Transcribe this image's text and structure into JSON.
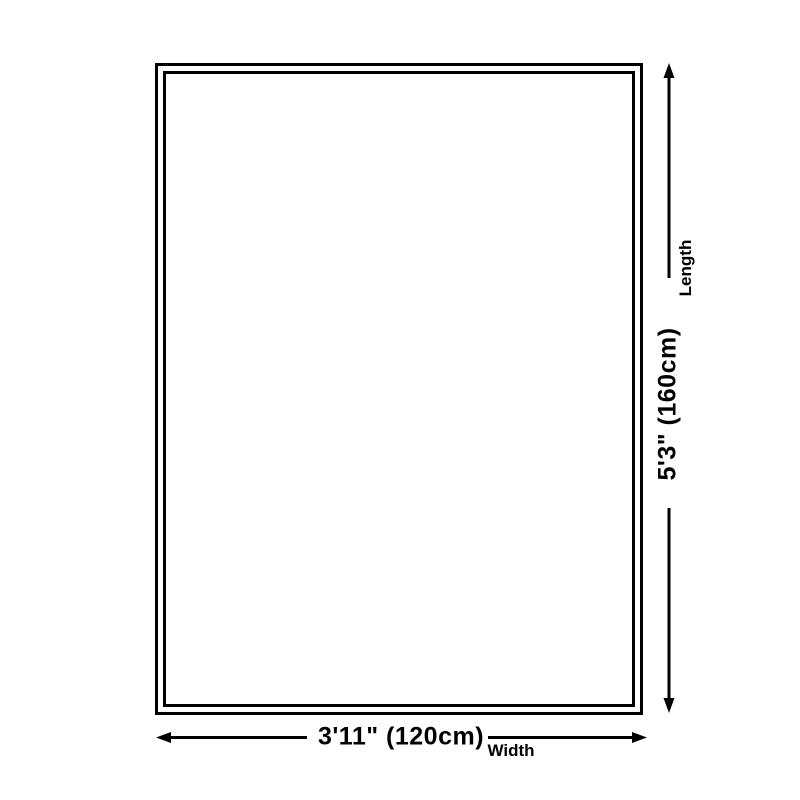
{
  "dimensions": {
    "length": {
      "value": "5'3\" (160cm)",
      "label": "Length"
    },
    "width": {
      "value": "3'11\" (120cm)",
      "label": "Width"
    }
  },
  "icons": {
    "length_arrow": "vertical-double-headed-arrow",
    "width_arrow": "horizontal-double-headed-arrow"
  },
  "colors": {
    "line": "#000000",
    "text": "#000000",
    "background": "#ffffff"
  }
}
